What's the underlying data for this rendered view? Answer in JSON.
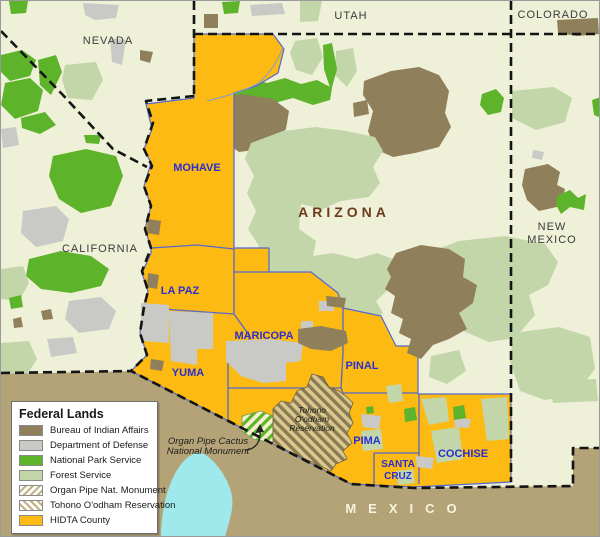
{
  "states": {
    "nevada": "NEVADA",
    "utah": "UTAH",
    "colorado": "COLORADO",
    "california": "CALIFORNIA",
    "new_mexico_line1": "NEW",
    "new_mexico_line2": "MEXICO",
    "arizona": "ARIZONA",
    "mexico": "MEXICO"
  },
  "counties": {
    "mohave": "MOHAVE",
    "la_paz": "LA PAZ",
    "yuma": "YUMA",
    "maricopa": "MARICOPA",
    "pinal": "PINAL",
    "pima": "PIMA",
    "santa_cruz_line1": "SANTA",
    "santa_cruz_line2": "CRUZ",
    "cochise": "COCHISE"
  },
  "annotations": {
    "tohono": [
      "Tohono",
      "O'odham",
      "Reservation"
    ],
    "organ_pipe": [
      "Organ Pipe Cactus",
      "National Monument"
    ]
  },
  "legend": {
    "title": "Federal Lands",
    "items": [
      {
        "id": "bia",
        "label": "Bureau of Indian Affairs",
        "color": "#8f7f5a"
      },
      {
        "id": "dod",
        "label": "Department of Defense",
        "color": "#c9cac5"
      },
      {
        "id": "nps",
        "label": "National Park Service",
        "color": "#5db32a"
      },
      {
        "id": "fs",
        "label": "Forest Service",
        "color": "#c3d6aa"
      },
      {
        "id": "organ",
        "label": "Organ Pipe Nat. Monument",
        "pattern": "diagonal-forward-hatch"
      },
      {
        "id": "tohono",
        "label": "Tohono O'odham Reservation",
        "pattern": "diagonal-back-hatch"
      },
      {
        "id": "hidta",
        "label": "HIDTA County",
        "color": "#fcba12"
      }
    ]
  },
  "colors": {
    "background": "#eef0d8",
    "hidta_gold": "#fcba12",
    "forest_service": "#c3d6aa",
    "national_park": "#5db32a",
    "dept_defense": "#c9cac5",
    "indian_affairs": "#8f7f5a",
    "mexico_land": "#b4a377",
    "water": "#9fe9ec",
    "county_border": "#5468cc",
    "county_label": "#2a2fd0",
    "state_border": "#141414",
    "arizona_label": "#6e3a1d"
  }
}
